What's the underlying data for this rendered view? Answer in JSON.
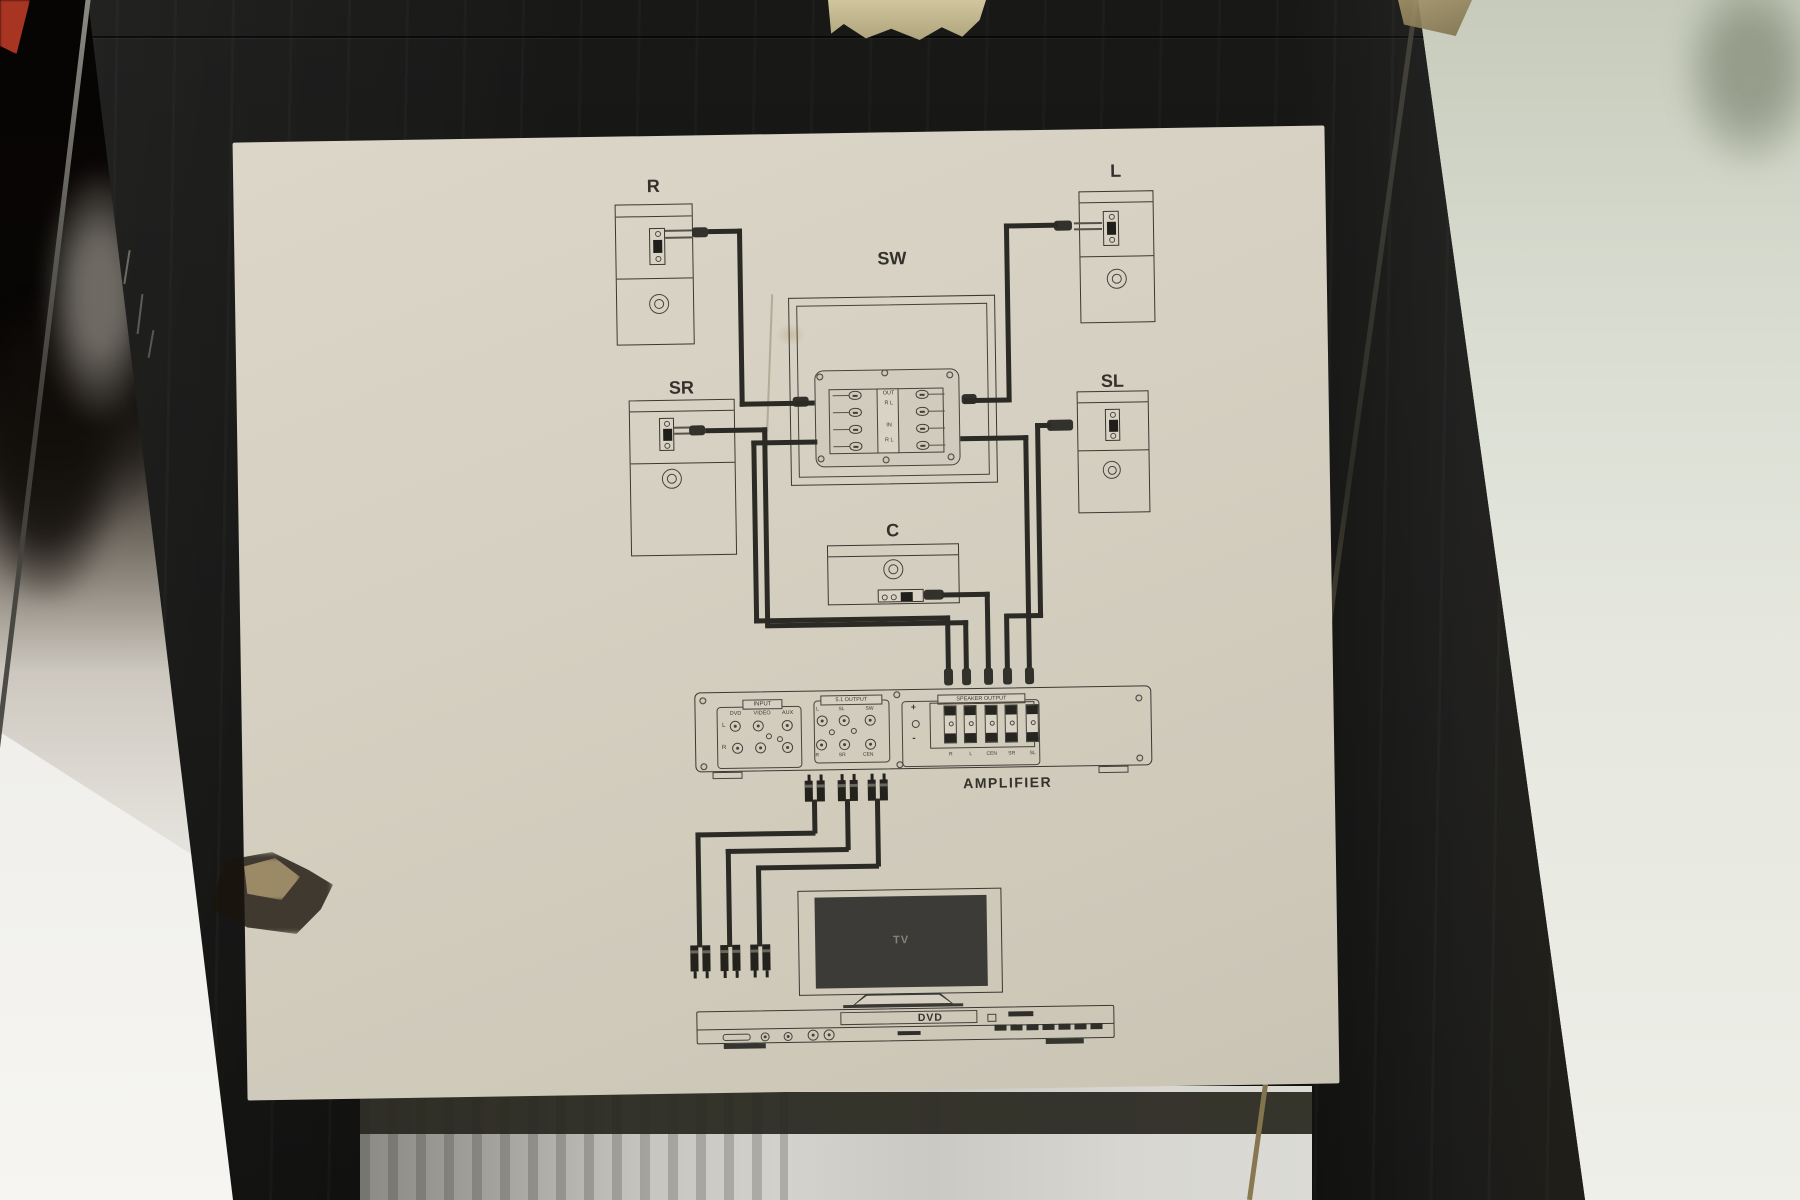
{
  "diagram": {
    "speakers": {
      "r": "R",
      "l": "L",
      "sr": "SR",
      "sl": "SL",
      "sw": "SW",
      "c": "C"
    },
    "plate": {
      "row1": "OUT",
      "row2_l": "R",
      "row2_r": "L",
      "row3": "IN",
      "row4_l": "R",
      "row4_r": "L"
    },
    "amp": {
      "name": "AMPLIFIER",
      "input_title": "INPUT",
      "input_cols": [
        "DVD",
        "VIDEO",
        "AUX"
      ],
      "input_rows": [
        "L",
        "R"
      ],
      "out51_title": "5.1 OUTPUT",
      "out51_top": [
        "L",
        "SL",
        "SW"
      ],
      "out51_bottom": [
        "R",
        "SR",
        "CEN"
      ],
      "spk_title": "SPEAKER OUTPUT",
      "plus": "+",
      "minus": "-",
      "spk_channels": [
        "R",
        "L",
        "CEN",
        "SR",
        "SL"
      ]
    },
    "tv": "TV",
    "dvd": "DVD"
  },
  "colors": {
    "box": "#131312",
    "label_paper": "#d6d0c2",
    "ink": "#3a3831",
    "tape": "#cdc199"
  }
}
